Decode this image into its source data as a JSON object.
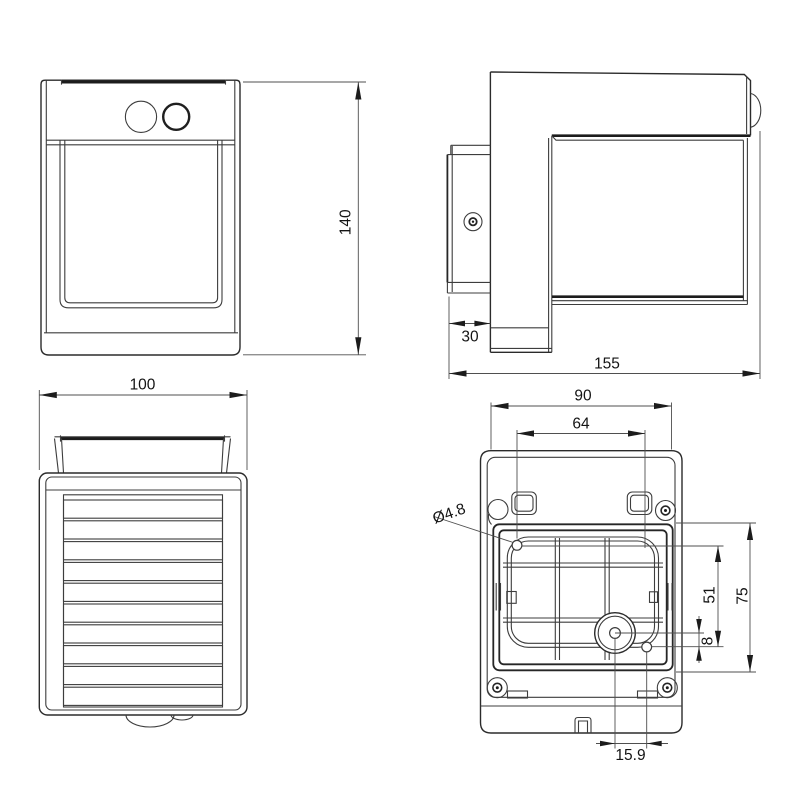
{
  "drawing": {
    "front_view": {
      "height_label": "140"
    },
    "side_view": {
      "wall_plate_depth_label": "30",
      "overall_depth_label": "155"
    },
    "bottom_view": {
      "width_label": "100"
    },
    "back_view": {
      "mount_width_label": "90",
      "inner_width_label": "64",
      "hole_diameter_label": "Ø4.8",
      "hole_offset_v_label": "51",
      "box_height_label": "75",
      "center_offset_v_label": "8",
      "center_offset_h_label": "15.9"
    }
  }
}
